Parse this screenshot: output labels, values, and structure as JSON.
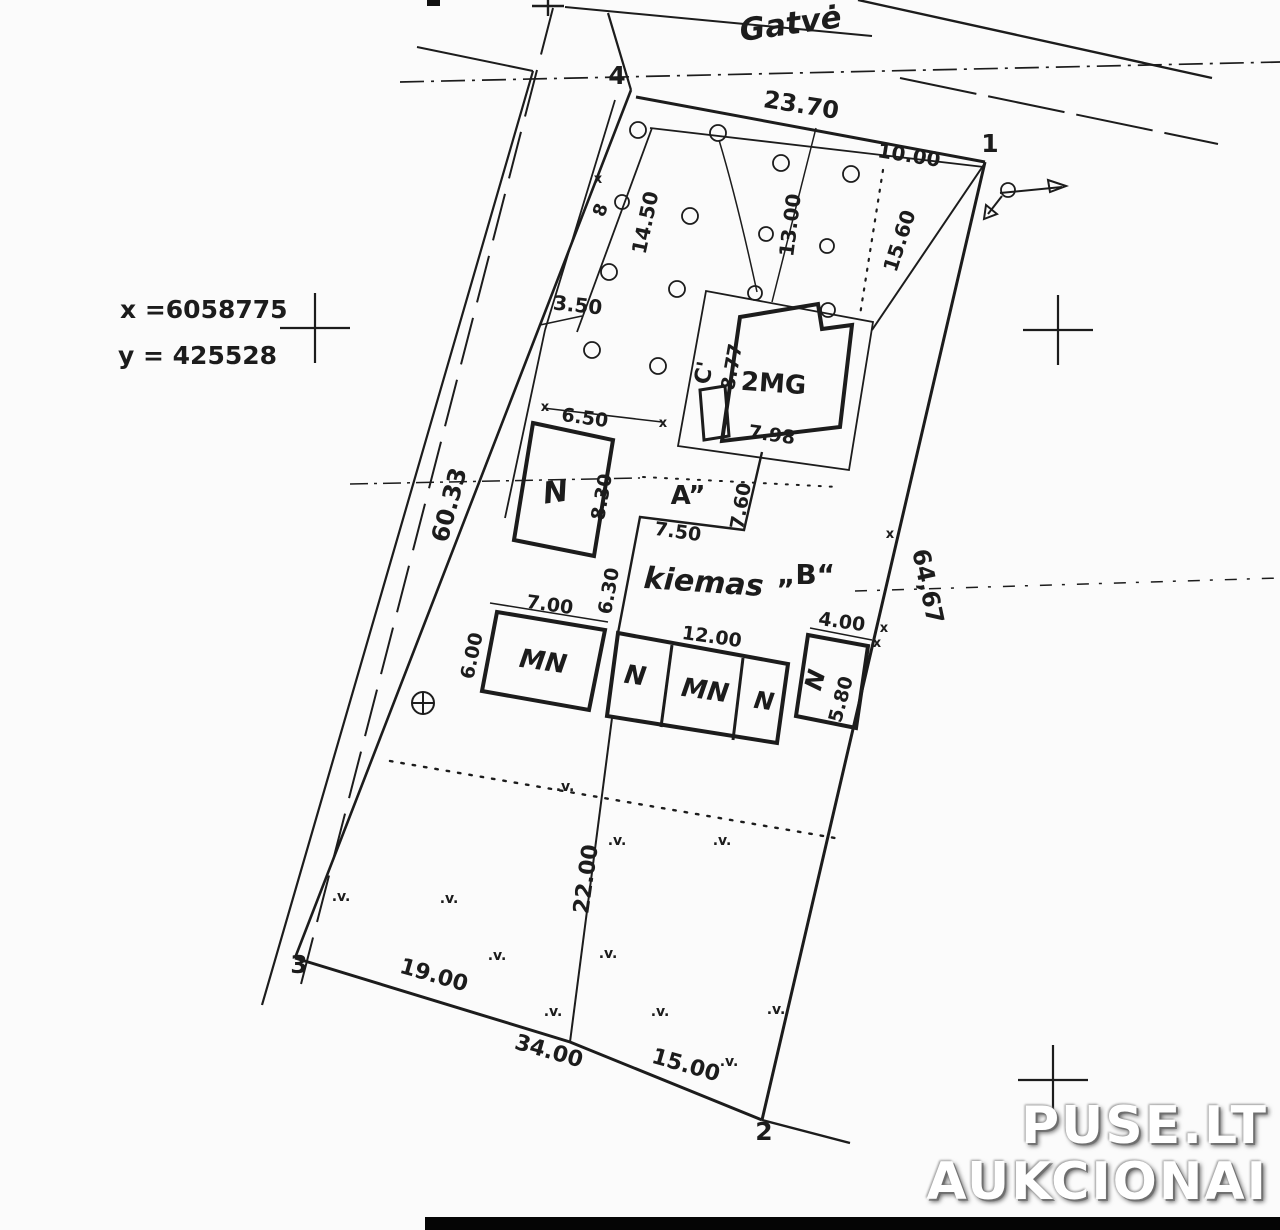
{
  "plan": {
    "street_label": {
      "t": "Gatvė",
      "x": 792,
      "y": 34,
      "r": -8,
      "s": 31,
      "i": true
    },
    "coordinates": [
      {
        "t": "x =6058775",
        "x": 120,
        "y": 318,
        "r": 0,
        "s": 25,
        "anchor": "start"
      },
      {
        "t": "y = 425528",
        "x": 118,
        "y": 364,
        "r": 0,
        "s": 25,
        "anchor": "start"
      }
    ],
    "corner_points": [
      {
        "t": "4",
        "x": 617,
        "y": 84,
        "s": 25
      },
      {
        "t": "1",
        "x": 990,
        "y": 152,
        "s": 25
      },
      {
        "t": "2",
        "x": 764,
        "y": 1140,
        "s": 25
      },
      {
        "t": "3",
        "x": 299,
        "y": 973,
        "s": 25
      }
    ],
    "dimensions": [
      {
        "t": "23.70",
        "x": 800,
        "y": 113,
        "r": 9,
        "s": 24
      },
      {
        "t": "10.00",
        "x": 908,
        "y": 162,
        "r": 9,
        "s": 20
      },
      {
        "t": "13.00",
        "x": 797,
        "y": 226,
        "r": -83,
        "s": 20
      },
      {
        "t": "15.60",
        "x": 906,
        "y": 243,
        "r": -72,
        "s": 20
      },
      {
        "t": "14.50",
        "x": 652,
        "y": 224,
        "r": -78,
        "s": 20
      },
      {
        "t": "3.50",
        "x": 577,
        "y": 312,
        "r": 6,
        "s": 20
      },
      {
        "t": "60.33",
        "x": 457,
        "y": 507,
        "r": -75,
        "s": 24
      },
      {
        "t": "64,67",
        "x": 920,
        "y": 588,
        "r": 78,
        "s": 24
      },
      {
        "t": "6.50",
        "x": 584,
        "y": 424,
        "r": 8,
        "s": 19
      },
      {
        "t": "8.30",
        "x": 608,
        "y": 498,
        "r": -80,
        "s": 19
      },
      {
        "t": "8.77",
        "x": 738,
        "y": 368,
        "r": -80,
        "s": 19
      },
      {
        "t": "7.98",
        "x": 771,
        "y": 441,
        "r": 8,
        "s": 19
      },
      {
        "t": "7.60",
        "x": 747,
        "y": 507,
        "r": -80,
        "s": 19
      },
      {
        "t": "7.50",
        "x": 677,
        "y": 538,
        "r": 8,
        "s": 19
      },
      {
        "t": "6.30",
        "x": 615,
        "y": 592,
        "r": -80,
        "s": 19
      },
      {
        "t": "7.00",
        "x": 549,
        "y": 611,
        "r": 8,
        "s": 19
      },
      {
        "t": "6.00",
        "x": 478,
        "y": 657,
        "r": -78,
        "s": 19
      },
      {
        "t": "12.00",
        "x": 711,
        "y": 643,
        "r": 8,
        "s": 19
      },
      {
        "t": "4.00",
        "x": 841,
        "y": 628,
        "r": 8,
        "s": 19
      },
      {
        "t": "5.80",
        "x": 847,
        "y": 701,
        "r": -75,
        "s": 19
      },
      {
        "t": "22.00",
        "x": 593,
        "y": 880,
        "r": -82,
        "s": 22
      },
      {
        "t": "19.00",
        "x": 432,
        "y": 982,
        "r": 16,
        "s": 22
      },
      {
        "t": "34.00",
        "x": 547,
        "y": 1058,
        "r": 16,
        "s": 22
      },
      {
        "t": "15.00",
        "x": 684,
        "y": 1072,
        "r": 16,
        "s": 22
      }
    ],
    "building_labels": [
      {
        "t": "2MG",
        "x": 773,
        "y": 392,
        "r": 4,
        "s": 26
      },
      {
        "t": "C'",
        "x": 711,
        "y": 374,
        "r": -80,
        "s": 22
      },
      {
        "t": "N",
        "x": 557,
        "y": 502,
        "r": -8,
        "s": 30,
        "i": true
      },
      {
        "t": "MN",
        "x": 542,
        "y": 670,
        "r": 8,
        "s": 26,
        "i": true
      },
      {
        "t": "N",
        "x": 634,
        "y": 684,
        "r": 8,
        "s": 26,
        "i": true
      },
      {
        "t": "MN",
        "x": 704,
        "y": 699,
        "r": 8,
        "s": 26,
        "i": true
      },
      {
        "t": "N",
        "x": 763,
        "y": 709,
        "r": 8,
        "s": 24,
        "i": true
      },
      {
        "t": "N",
        "x": 823,
        "y": 682,
        "r": -75,
        "s": 24,
        "i": true
      },
      {
        "t": "8",
        "x": 606,
        "y": 212,
        "r": -70,
        "s": 18
      }
    ],
    "area_labels": [
      {
        "t": "A”",
        "x": 688,
        "y": 504,
        "r": 0,
        "s": 26
      },
      {
        "t": "kiemas",
        "x": 703,
        "y": 592,
        "r": 4,
        "s": 30,
        "i": true
      },
      {
        "t": "„B“",
        "x": 806,
        "y": 584,
        "r": 0,
        "s": 28
      }
    ],
    "veg_symbol": ".v.",
    "vegetation_marks": [
      {
        "x": 565,
        "y": 791
      },
      {
        "x": 617,
        "y": 845
      },
      {
        "x": 722,
        "y": 845
      },
      {
        "x": 341,
        "y": 901
      },
      {
        "x": 449,
        "y": 903
      },
      {
        "x": 497,
        "y": 960
      },
      {
        "x": 608,
        "y": 958
      },
      {
        "x": 553,
        "y": 1016
      },
      {
        "x": 660,
        "y": 1016
      },
      {
        "x": 776,
        "y": 1014
      },
      {
        "x": 729,
        "y": 1066
      }
    ],
    "tick_symbol": "x",
    "tick_marks": [
      {
        "x": 598,
        "y": 183
      },
      {
        "x": 890,
        "y": 538
      },
      {
        "x": 884,
        "y": 632
      },
      {
        "x": 545,
        "y": 411
      },
      {
        "x": 663,
        "y": 427
      },
      {
        "x": 877,
        "y": 647
      }
    ]
  },
  "watermark": {
    "line1": "PUSE.LT",
    "line2": "AUKCIONAI"
  }
}
